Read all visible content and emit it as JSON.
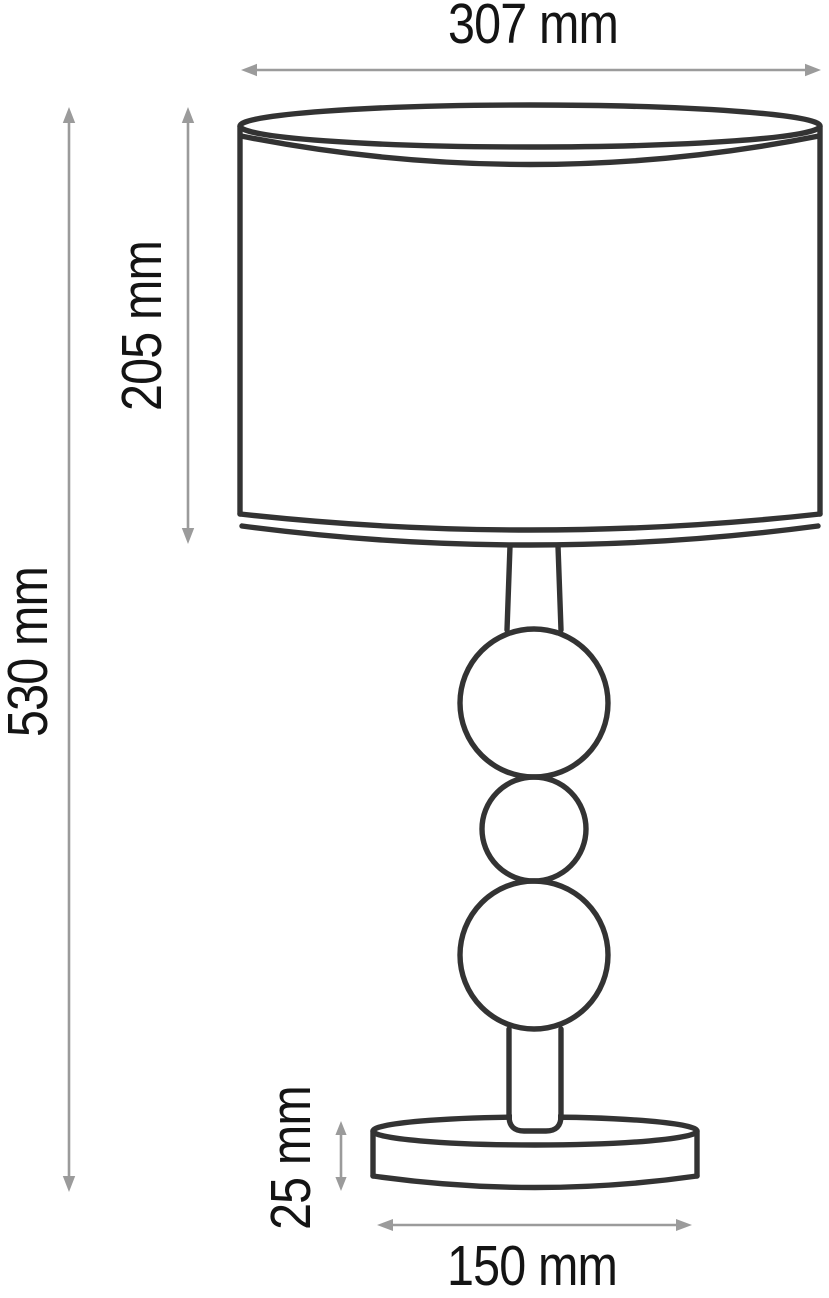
{
  "diagram": {
    "type": "technical dimension drawing",
    "subject": "table lamp with cylindrical shade, three-ball stem and round base",
    "units": "mm",
    "labels": {
      "shade_width": "307 mm",
      "shade_height": "205 mm",
      "total_height": "530 mm",
      "base_height": "25 mm",
      "base_diameter": "150 mm"
    },
    "colors": {
      "outline": "#333333",
      "dimension": "#9b9b9b",
      "text": "#141414",
      "background": "#ffffff"
    }
  }
}
